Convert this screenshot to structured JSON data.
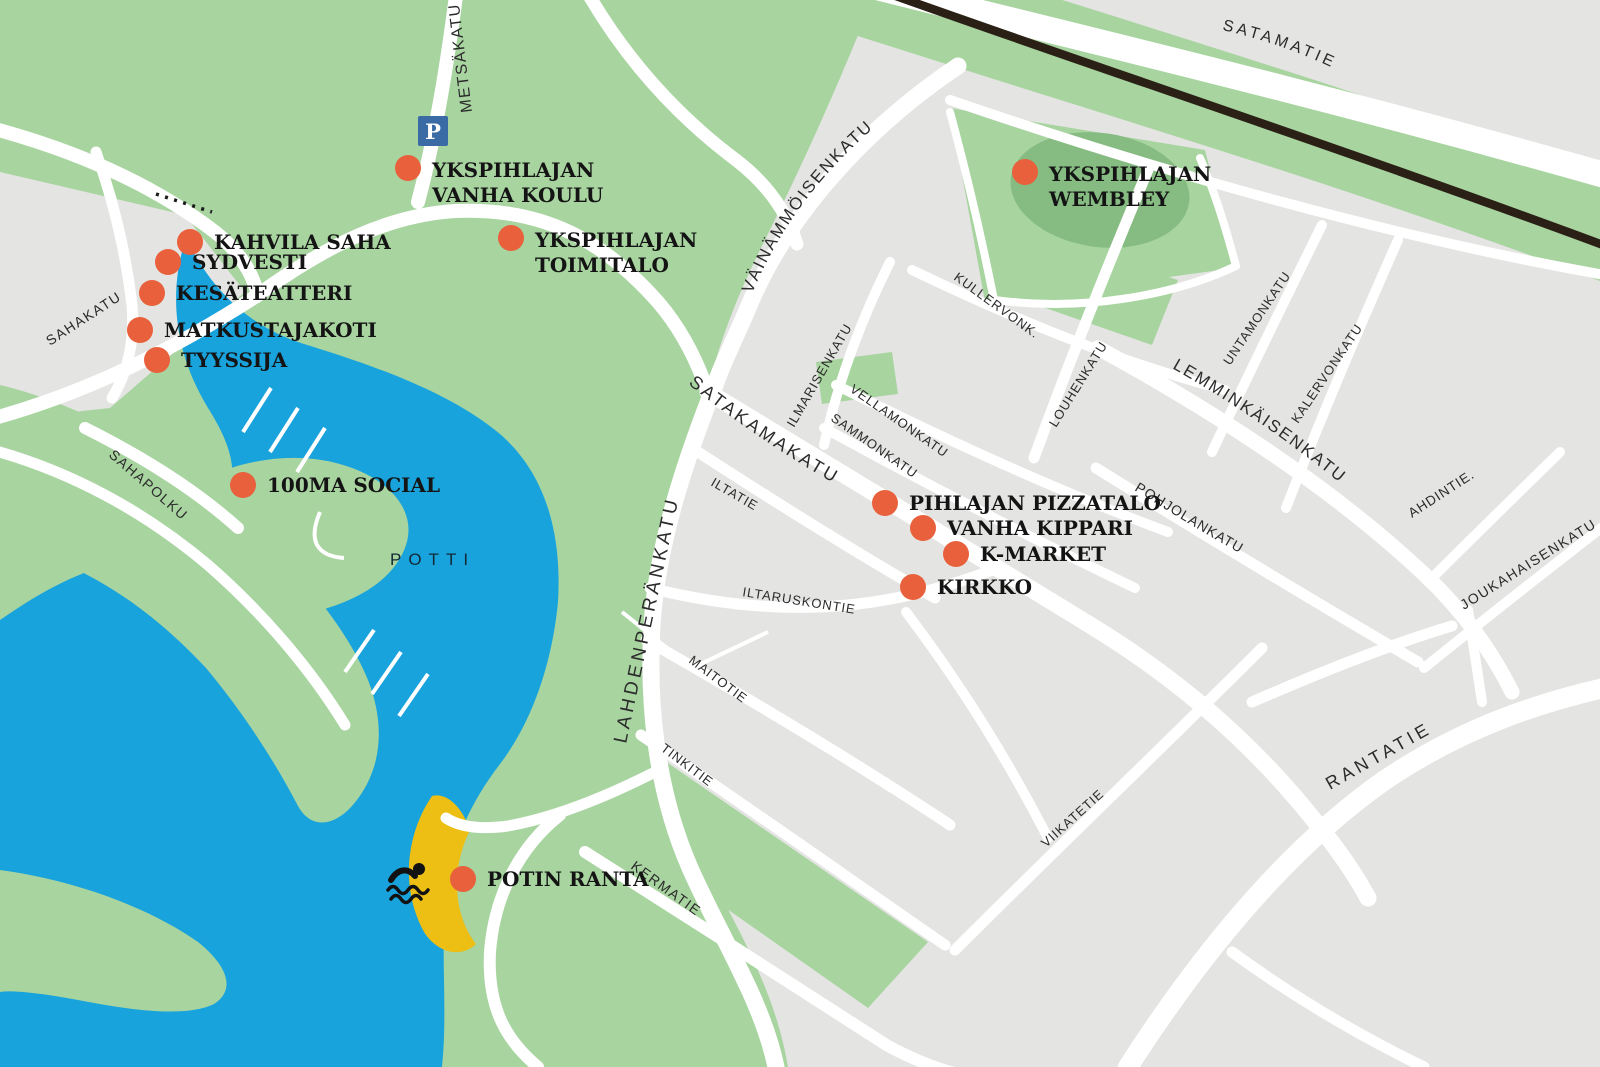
{
  "map": {
    "water_label": "POTTI",
    "parking": {
      "glyph": "P"
    },
    "colors": {
      "water": "#18A3DC",
      "green": "#A8D4A0",
      "green_dark": "#86BB82",
      "block_gray": "#E4E4E2",
      "road": "#FFFFFF",
      "railway": "#2A2015",
      "marker": "#E8603C",
      "beach": "#EDBE14",
      "parking": "#3A6BA4",
      "poi_text": "#141414",
      "street_text": "#2B2B2B",
      "water_text": "#132A36"
    },
    "streets": [
      {
        "name": "METSÄKATU"
      },
      {
        "name": "SATAMATIE"
      },
      {
        "name": "VÄINÄMMÖISENKATU"
      },
      {
        "name": "SAHAKATU"
      },
      {
        "name": "SAHAPOLKU"
      },
      {
        "name": "SATAKAMAKATU"
      },
      {
        "name": "ILMARISENKATU"
      },
      {
        "name": "VELLAMONKATU"
      },
      {
        "name": "SAMMONKATU"
      },
      {
        "name": "KULLERVONK."
      },
      {
        "name": "LOUHENKATU"
      },
      {
        "name": "UNTAMONKATU"
      },
      {
        "name": "KALERVONKATU"
      },
      {
        "name": "LEMMINKÄISENKATU"
      },
      {
        "name": "POHJOLANKATU"
      },
      {
        "name": "AHDINTIE."
      },
      {
        "name": "JOUKAHAISENKATU"
      },
      {
        "name": "ILTATIE"
      },
      {
        "name": "ILTARUSKONTIE"
      },
      {
        "name": "MAITOTIE"
      },
      {
        "name": "TINKITIE"
      },
      {
        "name": "VIIKATETIE"
      },
      {
        "name": "KERMATIE"
      },
      {
        "name": "LAHDENPERÄNKATU"
      },
      {
        "name": "RANTATIE"
      }
    ],
    "pois": [
      {
        "label": "YKSPIHLAJAN VANHA KOULU",
        "lines": [
          "YKSPIHLAJAN",
          "VANHA KOULU"
        ]
      },
      {
        "label": "KAHVILA SAHA",
        "lines": [
          "KAHVILA SAHA"
        ]
      },
      {
        "label": "SYDVESTI",
        "lines": [
          "SYDVESTI"
        ]
      },
      {
        "label": "KESÄTEATTERI",
        "lines": [
          "KESÄTEATTERI"
        ]
      },
      {
        "label": "MATKUSTAJAKOTI",
        "lines": [
          "MATKUSTAJAKOTI"
        ]
      },
      {
        "label": "TYYSSIJA",
        "lines": [
          "TYYSSIJA"
        ]
      },
      {
        "label": "100MA SOCIAL",
        "lines": [
          "100MA SOCIAL"
        ]
      },
      {
        "label": "YKSPIHLAJAN TOIMITALO",
        "lines": [
          "YKSPIHLAJAN",
          "TOIMITALO"
        ]
      },
      {
        "label": "YKSPIHLAJAN WEMBLEY",
        "lines": [
          "YKSPIHLAJAN",
          "WEMBLEY"
        ]
      },
      {
        "label": "PIHLAJAN PIZZATALO",
        "lines": [
          "PIHLAJAN PIZZATALO"
        ]
      },
      {
        "label": "VANHA KIPPARI",
        "lines": [
          "VANHA KIPPARI"
        ]
      },
      {
        "label": "K-MARKET",
        "lines": [
          "K-MARKET"
        ]
      },
      {
        "label": "KIRKKO",
        "lines": [
          "KIRKKO"
        ]
      },
      {
        "label": "POTIN RANTA",
        "lines": [
          "POTIN RANTA"
        ]
      }
    ]
  }
}
